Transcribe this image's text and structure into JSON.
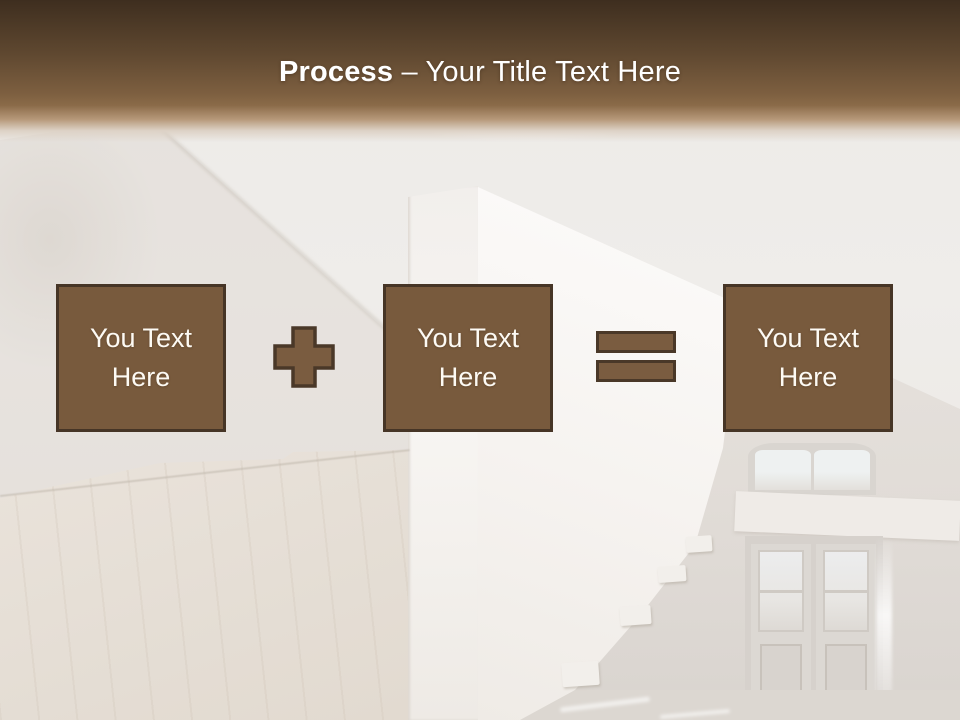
{
  "title": {
    "bold": "Process",
    "rest": "– Your Title Text Here"
  },
  "boxes": [
    {
      "label": "You Text Here"
    },
    {
      "label": "You Text Here"
    },
    {
      "label": "You Text Here"
    }
  ],
  "operators": [
    {
      "name": "plus"
    },
    {
      "name": "equals"
    }
  ],
  "colors": {
    "header_top": "#3e2e1f",
    "header_mid": "#5f4830",
    "header_bottom": "#8a6a48",
    "bg_base": "#edeae6",
    "box_fill": "#785a3d",
    "box_border": "#463526",
    "op_fill": "#7a5c40",
    "op_border": "#4a3828",
    "text_white": "#ffffff"
  }
}
